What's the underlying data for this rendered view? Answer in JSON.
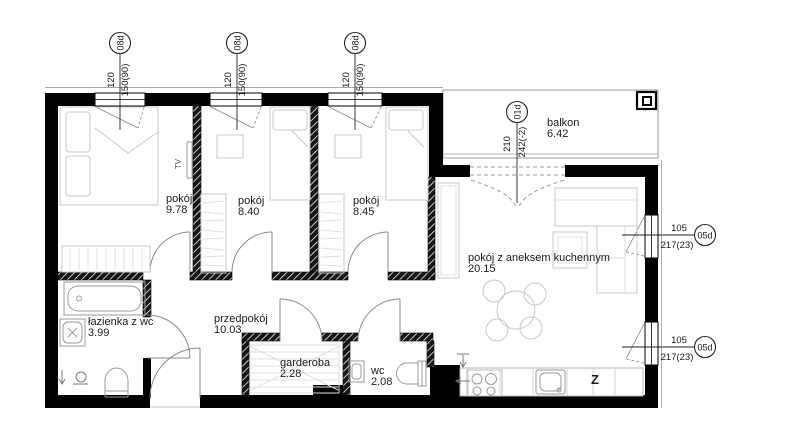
{
  "rooms": {
    "pokoj1": {
      "name": "pokój",
      "area": "9.78"
    },
    "pokoj2": {
      "name": "pokój",
      "area": "8.40"
    },
    "pokoj3": {
      "name": "pokój",
      "area": "8.45"
    },
    "living": {
      "name": "pokój z aneksem kuchennym",
      "area": "20.15"
    },
    "balkon": {
      "name": "balkon",
      "area": "6.42"
    },
    "lazienka": {
      "name": "łazienka z wc",
      "area": "3.99"
    },
    "przedpokoj": {
      "name": "przedpokój",
      "area": "10.03"
    },
    "garderoba": {
      "name": "garderoba",
      "area": "2.28"
    },
    "wc": {
      "name": "wc",
      "area": "2.08"
    }
  },
  "dimensions": {
    "top_window": {
      "code": "08d",
      "width": "120",
      "height": "150(90)"
    },
    "balcony_door": {
      "code": "01d",
      "width": "210",
      "height": "242(-2)"
    },
    "right_window": {
      "code": "05d",
      "width": "105",
      "height": "217(23)"
    }
  },
  "annotations": {
    "tv": "TV",
    "dishwasher": "Z"
  },
  "colors": {
    "wall": "#000000",
    "furniture": "#c8c8c8",
    "fixture": "#999999",
    "door": "#8a8a8a",
    "dimension": "#1f1f1f",
    "background": "#ffffff"
  }
}
